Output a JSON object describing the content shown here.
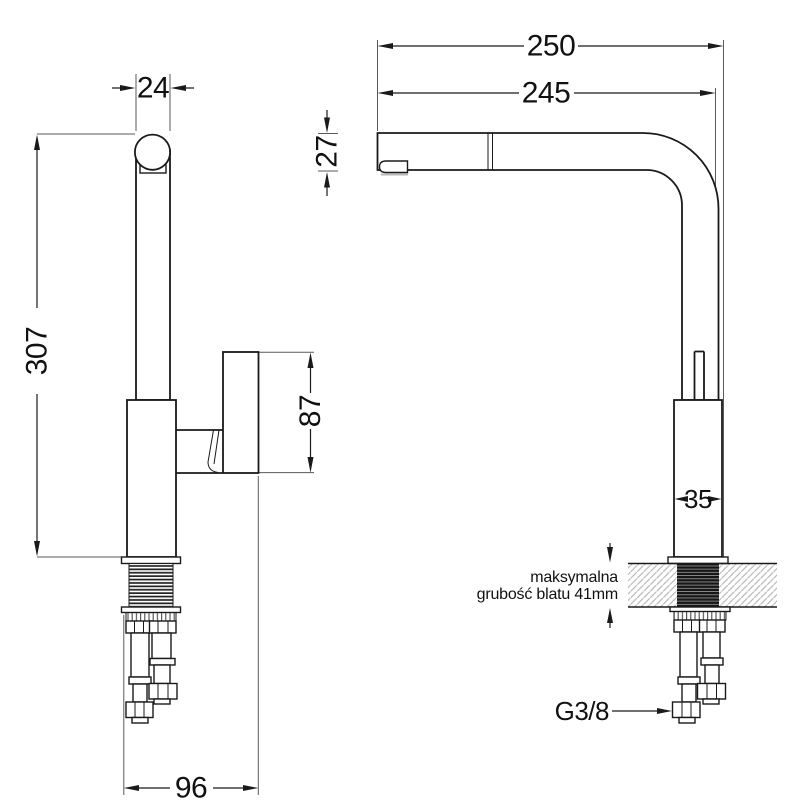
{
  "drawing": {
    "product": "kitchen faucet installation dimension drawing",
    "front_view": {
      "spout_tube_width": "24",
      "total_height": "307",
      "handle_height": "87",
      "base_depth": "96"
    },
    "side_view": {
      "overall_reach": "250",
      "spout_reach": "245",
      "spout_head_height": "27",
      "body_width": "35",
      "countertop_note_line1": "maksymalna",
      "countertop_note_line2": "grubość blatu 41mm",
      "supply_thread": "G3/8"
    }
  }
}
